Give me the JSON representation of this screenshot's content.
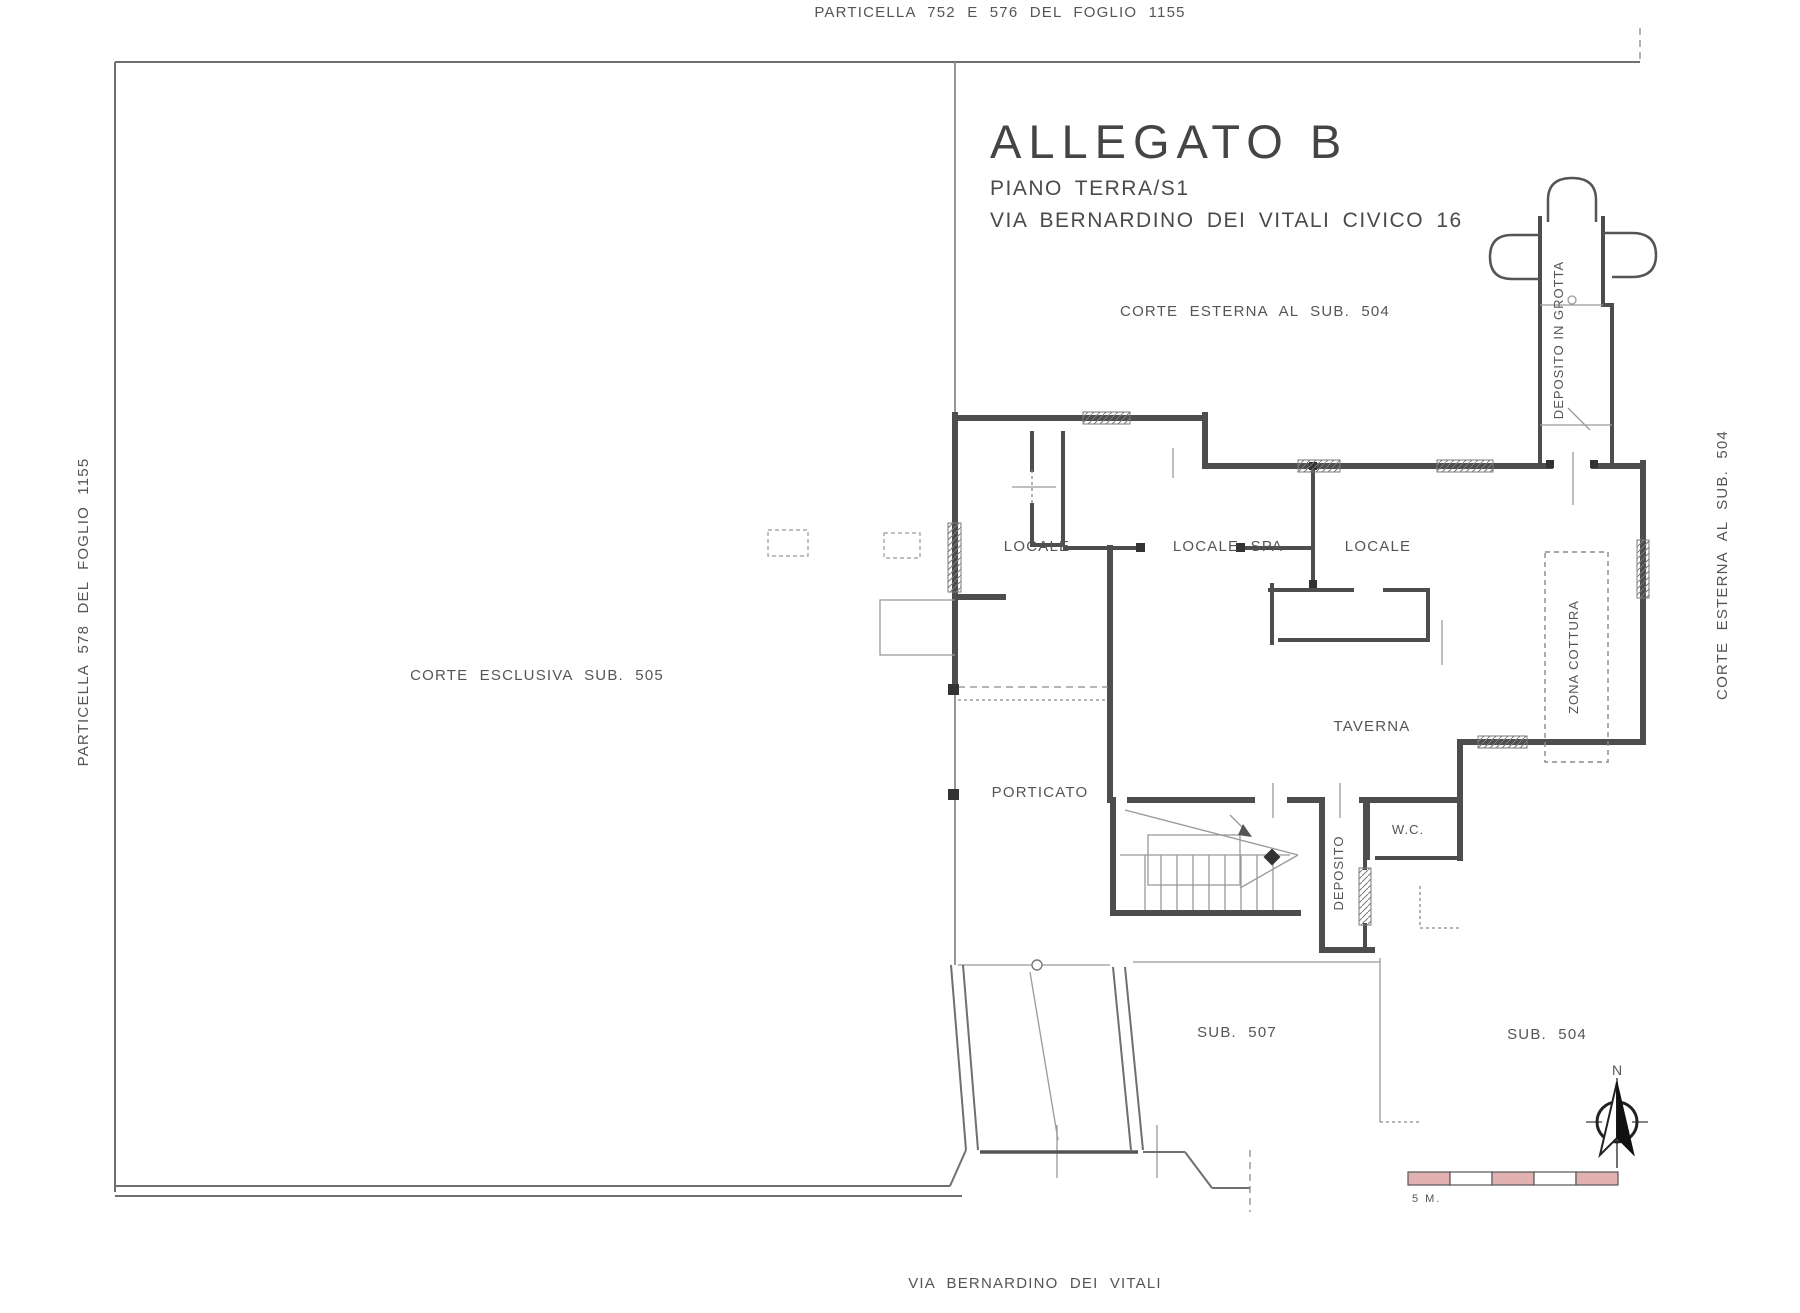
{
  "boundaries": {
    "top_parcel": "PARTICELLA 752 E 576 DEL FOGLIO 1155",
    "left_parcel": "PARTICELLA 578 DEL FOGLIO 1155",
    "right_court": "CORTE ESTERNA AL SUB. 504",
    "street": "VIA BERNARDINO DEI VITALI"
  },
  "title_block": {
    "title": "ALLEGATO B",
    "floor": "PIANO TERRA/S1",
    "address": "VIA BERNARDINO DEI VITALI CIVICO 16"
  },
  "areas": {
    "corte_esterna": "CORTE ESTERNA AL SUB. 504",
    "corte_esclusiva": "CORTE ESCLUSIVA SUB. 505",
    "sub_507": "SUB. 507",
    "sub_504": "SUB. 504"
  },
  "rooms": {
    "locale_1": "LOCALE",
    "locale_spa": "LOCALE SPA",
    "locale_2": "LOCALE",
    "taverna": "TAVERNA",
    "porticato": "PORTICATO",
    "wc": "W.C.",
    "deposito": "DEPOSITO",
    "zona_cottura": "ZONA COTTURA",
    "deposito_in_grotta": "DEPOSITO IN GROTTA"
  },
  "compass": {
    "north": "N"
  },
  "scale_bar": {
    "label": "5 M."
  },
  "colors": {
    "wall": "#4d4d4d",
    "thin_line": "#999999",
    "scale_pink": "#e2b1b1",
    "background": "#ffffff"
  }
}
